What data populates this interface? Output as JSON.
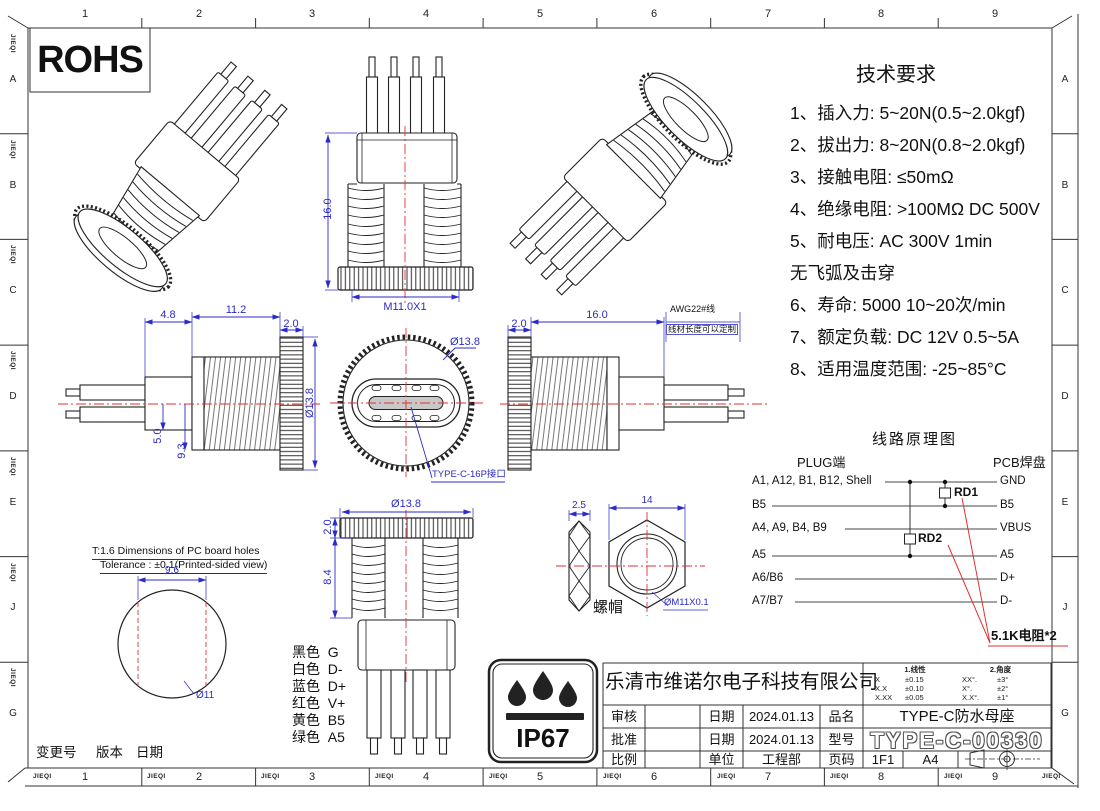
{
  "sheet": {
    "brand": "JIEQI",
    "cols": [
      "1",
      "2",
      "3",
      "4",
      "5",
      "6",
      "7",
      "8",
      "9"
    ],
    "rows": [
      "A",
      "B",
      "C",
      "D",
      "E",
      "J",
      "G"
    ]
  },
  "rohs_label": "ROHS",
  "ip67_label": "IP67",
  "tech": {
    "title": "技术要求",
    "lines": [
      "1、插入力: 5~20N(0.5~2.0kgf)",
      "2、拔出力: 8~20N(0.8~2.0kgf)",
      "3、接触电阻: ≤50mΩ",
      "4、绝缘电阻: >100MΩ  DC  500V",
      "5、耐电压: AC  300V  1min",
      "无飞弧及击穿",
      "6、寿命:  5000 10~20次/min",
      "7、额定负载: DC  12V  0.5~5A",
      "8、适用温度范围: -25~85°C"
    ]
  },
  "dims": {
    "front": {
      "height": "16.0",
      "thread": "M11.0X1"
    },
    "side_left": {
      "a": "4.8",
      "b": "11.2",
      "c": "2.0",
      "dia": "Ø13.8",
      "d": "5.0",
      "e": "9.3"
    },
    "face": {
      "dia": "Ø13.8",
      "port": "TYPE-C-16P接口"
    },
    "side_right": {
      "c": "2.0",
      "len": "16.0",
      "wire": "AWG22#线",
      "wire_note": "线材长度可以定制"
    },
    "bottom": {
      "dia": "Ø13.8",
      "c": "2.0",
      "h": "8.4"
    },
    "nut": {
      "t": "2.5",
      "w": "14",
      "name": "螺帽",
      "thread": "ØM11X0.1"
    }
  },
  "pcboard": {
    "title": "T:1.6 Dimensions of PC board holes",
    "tolerance": "Tolerance : ±0.1(Printed-sided view)",
    "width": "9.6",
    "dia": "Ø11"
  },
  "legend": [
    {
      "color": "黑色",
      "signal": "G"
    },
    {
      "color": "白色",
      "signal": "D-"
    },
    {
      "color": "蓝色",
      "signal": "D+"
    },
    {
      "color": "红色",
      "signal": "V+"
    },
    {
      "color": "黄色",
      "signal": "B5"
    },
    {
      "color": "绿色",
      "signal": "A5"
    }
  ],
  "revision": {
    "change": "变更号",
    "version": "版本",
    "date": "日期"
  },
  "schematic": {
    "title": "线路原理图",
    "plug": "PLUG端",
    "pcb": "PCB焊盘",
    "rows": [
      {
        "l": "A1, A12, B1, B12, Shell",
        "r": "GND"
      },
      {
        "l": "B5",
        "r": "B5"
      },
      {
        "l": "A4, A9, B4, B9",
        "r": "VBUS"
      },
      {
        "l": "A5",
        "r": "A5"
      },
      {
        "l": "A6/B6",
        "r": "D+"
      },
      {
        "l": "A7/B7",
        "r": "D-"
      }
    ],
    "rd1": "RD1",
    "rd2": "RD2",
    "note": "5.1K电阻*2"
  },
  "tb": {
    "company": "乐清市维诺尔电子科技有限公司",
    "tol": {
      "t1": "1.线性",
      "t2": "2.角度",
      "lin": [
        {
          "k": "X",
          "v": "±0.15"
        },
        {
          "k": "X.X",
          "v": "±0.10"
        },
        {
          "k": "X.XX",
          "v": "±0.05"
        }
      ],
      "ang": [
        {
          "k": "XX°.",
          "v": "±3°"
        },
        {
          "k": "X°.",
          "v": "±2°"
        },
        {
          "k": "X.X°.",
          "v": "±1°"
        }
      ]
    },
    "shenhe": "审核",
    "pizhun": "批准",
    "bili": "比例",
    "riqi": "日期",
    "danwei": "单位",
    "pinming": "品名",
    "xinghao": "型号",
    "yema": "页码",
    "date1": "2024.01.13",
    "date2": "2024.01.13",
    "dept": "工程部",
    "part": "TYPE-C防水母座",
    "model": "TYPE-C-00330",
    "page": "1F1",
    "size": "A4"
  }
}
